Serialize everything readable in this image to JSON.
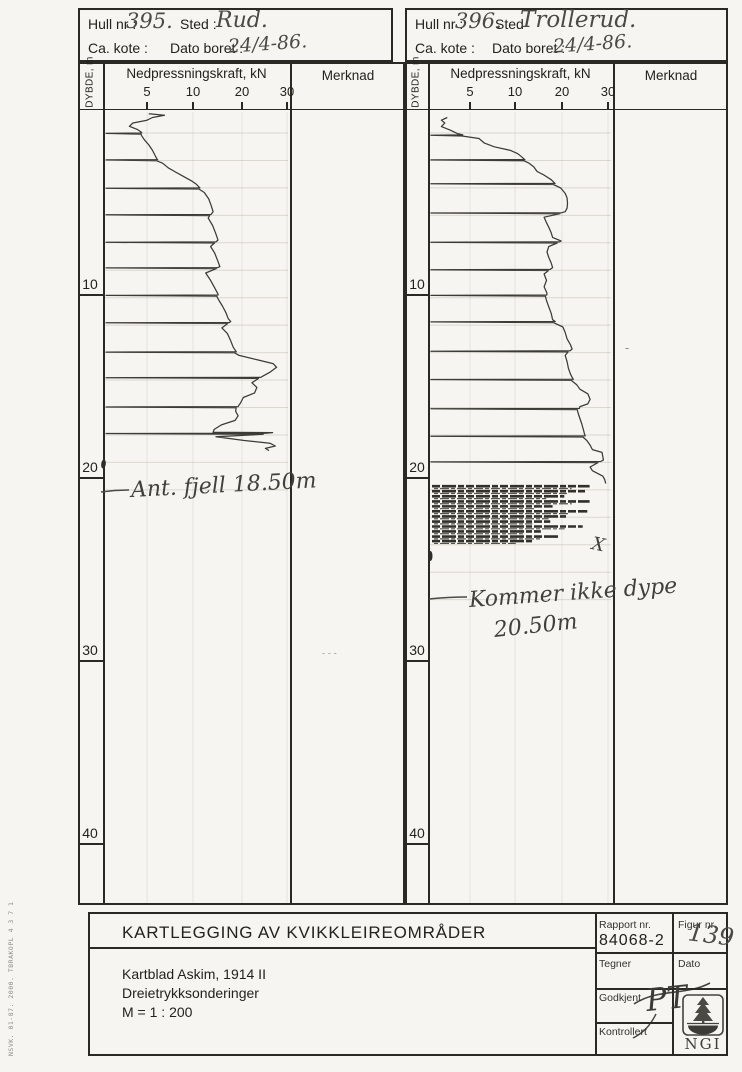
{
  "page": {
    "margin_note": "NSVK. 01-87. 2000. TBRAKOPL 4 3 7 1"
  },
  "charts": [
    {
      "header": {
        "hull_label": "Hull nr :",
        "hull_value": "395.",
        "sted_label": "Sted :",
        "sted_value": "Rud.",
        "kote_label": "Ca. kote :",
        "dato_label": "Dato boret :",
        "dato_value": "24/4-86."
      },
      "axis": {
        "depth_label": "DYBDE, m",
        "force_label": "Nedpressningskraft, kN",
        "merknad_label": "Merknad"
      }
    },
    {
      "header": {
        "hull_label": "Hull nr :",
        "hull_value": "396.",
        "sted_label": "Sted",
        "sted_value": "Trollerud.",
        "kote_label": "Ca. kote :",
        "dato_label": "Dato boret :",
        "dato_value": "24/4-86."
      },
      "axis": {
        "depth_label": "DYBDE, m",
        "force_label": "Nedpressningskraft, kN",
        "merknad_label": "Merknad"
      }
    }
  ],
  "chart_data": [
    {
      "type": "line",
      "title": "Dreietrykksondering Hull 395, Rud",
      "xlabel": "Nedpressningskraft, kN",
      "ylabel": "Dybde, m",
      "x_ticks": [
        5,
        10,
        20,
        30
      ],
      "depth_ticks": [
        10,
        20,
        30,
        40
      ],
      "ylim": [
        0,
        43
      ],
      "end_depth": 18.5,
      "series": [
        {
          "name": "Nedpressningskraft",
          "points": [
            [
              0.1,
              5.2
            ],
            [
              0.18,
              6.9
            ],
            [
              0.3,
              5.6
            ],
            [
              0.45,
              5.0
            ],
            [
              0.6,
              3.4
            ],
            [
              0.78,
              3.0
            ],
            [
              0.95,
              3.9
            ],
            [
              1.12,
              4.4
            ],
            [
              1.3,
              4.4
            ],
            [
              1.52,
              4.7
            ],
            [
              1.8,
              5.2
            ],
            [
              2.1,
              5.6
            ],
            [
              2.4,
              5.9
            ],
            [
              2.58,
              6.1
            ],
            [
              2.8,
              6.7
            ],
            [
              3.05,
              7.3
            ],
            [
              3.25,
              8.0
            ],
            [
              3.45,
              8.7
            ],
            [
              3.62,
              9.3
            ],
            [
              3.78,
              9.9
            ],
            [
              3.95,
              10.7
            ],
            [
              4.12,
              11.3
            ],
            [
              4.4,
              12.3
            ],
            [
              4.75,
              13.2
            ],
            [
              5.1,
              13.7
            ],
            [
              5.45,
              14.1
            ],
            [
              5.8,
              13.1
            ],
            [
              6.2,
              14.0
            ],
            [
              6.6,
              14.6
            ],
            [
              7.0,
              15.1
            ],
            [
              7.35,
              13.6
            ],
            [
              7.7,
              14.4
            ],
            [
              8.1,
              15.0
            ],
            [
              8.45,
              15.5
            ],
            [
              8.8,
              12.6
            ],
            [
              9.2,
              13.6
            ],
            [
              9.6,
              14.4
            ],
            [
              9.95,
              15.1
            ],
            [
              10.3,
              15.3
            ],
            [
              10.6,
              16.0
            ],
            [
              10.95,
              16.7
            ],
            [
              11.3,
              17.2
            ],
            [
              11.45,
              17.7
            ],
            [
              11.8,
              15.9
            ],
            [
              12.1,
              17.0
            ],
            [
              12.5,
              17.7
            ],
            [
              12.85,
              18.2
            ],
            [
              13.05,
              18.7
            ],
            [
              13.3,
              19.4
            ],
            [
              13.55,
              23.6
            ],
            [
              13.75,
              26.9
            ],
            [
              13.95,
              27.7
            ],
            [
              14.2,
              26.3
            ],
            [
              14.45,
              24.5
            ],
            [
              14.8,
              22.2
            ],
            [
              15.05,
              23.3
            ],
            [
              15.35,
              22.8
            ],
            [
              15.6,
              20.3
            ],
            [
              15.9,
              19.7
            ],
            [
              16.05,
              19.3
            ],
            [
              16.35,
              18.7
            ],
            [
              16.6,
              19.2
            ],
            [
              16.85,
              18.6
            ],
            [
              17.1,
              15.8
            ],
            [
              17.35,
              14.3
            ],
            [
              17.5,
              14.1
            ],
            [
              17.52,
              26.8
            ],
            [
              17.75,
              14.7
            ],
            [
              17.95,
              20.5
            ],
            [
              18.1,
              26.2
            ],
            [
              18.25,
              27.4
            ],
            [
              18.38,
              25.2
            ],
            [
              18.5,
              26.0
            ]
          ]
        }
      ],
      "reset_depths": [
        1.15,
        2.6,
        4.15,
        5.6,
        7.1,
        8.5,
        10.0,
        11.5,
        13.1,
        14.5,
        16.1,
        17.55
      ],
      "annotations": [
        {
          "text": "Ant. fjell 18.50m",
          "x": 131,
          "y": 500,
          "size": 22,
          "rot": -3
        },
        {
          "text": "- - -",
          "x": 322,
          "y": 658,
          "size": 9,
          "rot": 0,
          "color": "#8b8b86"
        }
      ],
      "pointer": {
        "x1": 101,
        "y1": 492,
        "x2": 129,
        "y2": 490
      }
    },
    {
      "type": "line",
      "title": "Dreietrykksondering Hull 396, Trollerud",
      "xlabel": "Nedpressningskraft, kN",
      "ylabel": "Dybde, m",
      "x_ticks": [
        5,
        10,
        20,
        30
      ],
      "depth_ticks": [
        10,
        20,
        30,
        40
      ],
      "ylim": [
        0,
        43
      ],
      "end_depth": 20.5,
      "series": [
        {
          "name": "Nedpressningskraft",
          "points": [
            [
              0.3,
              2.3
            ],
            [
              0.45,
              1.6
            ],
            [
              0.6,
              2.0
            ],
            [
              0.8,
              1.6
            ],
            [
              1.0,
              2.7
            ],
            [
              1.18,
              3.5
            ],
            [
              1.45,
              6.0
            ],
            [
              1.7,
              6.6
            ],
            [
              1.9,
              7.7
            ],
            [
              2.1,
              9.5
            ],
            [
              2.28,
              10.6
            ],
            [
              2.45,
              11.4
            ],
            [
              2.56,
              11.9
            ],
            [
              2.8,
              13.0
            ],
            [
              3.0,
              14.0
            ],
            [
              3.25,
              14.7
            ],
            [
              3.45,
              16.2
            ],
            [
              3.7,
              17.7
            ],
            [
              3.85,
              18.3
            ],
            [
              4.15,
              19.7
            ],
            [
              4.45,
              20.7
            ],
            [
              4.7,
              21.1
            ],
            [
              5.0,
              21.2
            ],
            [
              5.25,
              21.1
            ],
            [
              5.45,
              20.7
            ],
            [
              5.75,
              16.2
            ],
            [
              6.05,
              16.7
            ],
            [
              6.3,
              17.2
            ],
            [
              6.6,
              17.7
            ],
            [
              6.85,
              18.0
            ],
            [
              7.05,
              19.8
            ],
            [
              7.35,
              17.2
            ],
            [
              7.65,
              16.8
            ],
            [
              7.95,
              17.2
            ],
            [
              8.25,
              17.7
            ],
            [
              8.5,
              18.0
            ],
            [
              8.85,
              16.2
            ],
            [
              9.2,
              16.7
            ],
            [
              9.55,
              16.2
            ],
            [
              9.9,
              16.8
            ],
            [
              10.3,
              16.7
            ],
            [
              10.65,
              17.2
            ],
            [
              11.0,
              17.7
            ],
            [
              11.35,
              18.0
            ],
            [
              11.75,
              20.2
            ],
            [
              12.05,
              20.7
            ],
            [
              12.4,
              21.1
            ],
            [
              12.7,
              21.8
            ],
            [
              12.95,
              22.2
            ],
            [
              13.3,
              20.7
            ],
            [
              13.65,
              21.1
            ],
            [
              14.0,
              21.4
            ],
            [
              14.3,
              21.8
            ],
            [
              14.5,
              22.2
            ],
            [
              14.9,
              23.2
            ],
            [
              15.15,
              23.9
            ],
            [
              15.4,
              25.6
            ],
            [
              15.7,
              26.1
            ],
            [
              15.95,
              25.6
            ],
            [
              16.1,
              23.9
            ],
            [
              16.45,
              23.5
            ],
            [
              16.75,
              23.9
            ],
            [
              17.05,
              24.3
            ],
            [
              17.4,
              24.7
            ],
            [
              17.6,
              24.9
            ],
            [
              17.95,
              25.4
            ],
            [
              18.2,
              26.1
            ],
            [
              18.45,
              26.6
            ],
            [
              18.6,
              28.7
            ],
            [
              18.85,
              28.9
            ],
            [
              19.02,
              29.0
            ],
            [
              19.4,
              26.1
            ],
            [
              19.6,
              26.6
            ],
            [
              19.9,
              28.9
            ],
            [
              20.1,
              29.3
            ],
            [
              20.3,
              29.5
            ]
          ]
        }
      ],
      "reset_depths": [
        1.25,
        2.6,
        3.9,
        5.5,
        7.1,
        8.6,
        10.0,
        11.45,
        13.05,
        14.6,
        16.2,
        17.7,
        19.1
      ],
      "hatch_rows": [
        [
          20.45,
          26.0
        ],
        [
          20.72,
          25.0
        ],
        [
          21.0,
          20.5
        ],
        [
          21.28,
          26.0
        ],
        [
          21.55,
          18.0
        ],
        [
          21.82,
          25.5
        ],
        [
          22.1,
          21.0
        ],
        [
          22.38,
          17.5
        ],
        [
          22.65,
          24.5
        ],
        [
          22.92,
          15.5
        ],
        [
          23.2,
          19.5
        ],
        [
          23.45,
          14.0
        ]
      ],
      "annotations": [
        {
          "text": "Kommer ikke dype",
          "x": 469,
          "y": 610,
          "size": 22,
          "rot": -4
        },
        {
          "text": "20.50m",
          "x": 494,
          "y": 640,
          "size": 22,
          "rot": -6
        },
        {
          "text": "X",
          "x": 592,
          "y": 551,
          "size": 18,
          "rot": 12
        },
        {
          "text": "-",
          "x": 625,
          "y": 353,
          "size": 12,
          "rot": 0,
          "color": "#77766f"
        }
      ],
      "pointer": {
        "x1": 429,
        "y1": 599,
        "x2": 467,
        "y2": 597
      }
    }
  ],
  "titleblock": {
    "title": "KARTLEGGING AV KVIKKLEIREOMRÅDER",
    "lines": [
      "Kartblad Askim, 1914 II",
      "Dreietrykksonderinger",
      "M = 1 : 200"
    ],
    "rapport_label": "Rapport nr.",
    "rapport_value": "84068-2",
    "figur_label": "Figur nr.",
    "figur_value": "139",
    "tegner_label": "Tegner",
    "dato_label": "Dato",
    "godkjent_label": "Godkjent",
    "godkjent_signature": "PT",
    "kontrollert_label": "Kontrollert",
    "logo_text": "NGI"
  }
}
